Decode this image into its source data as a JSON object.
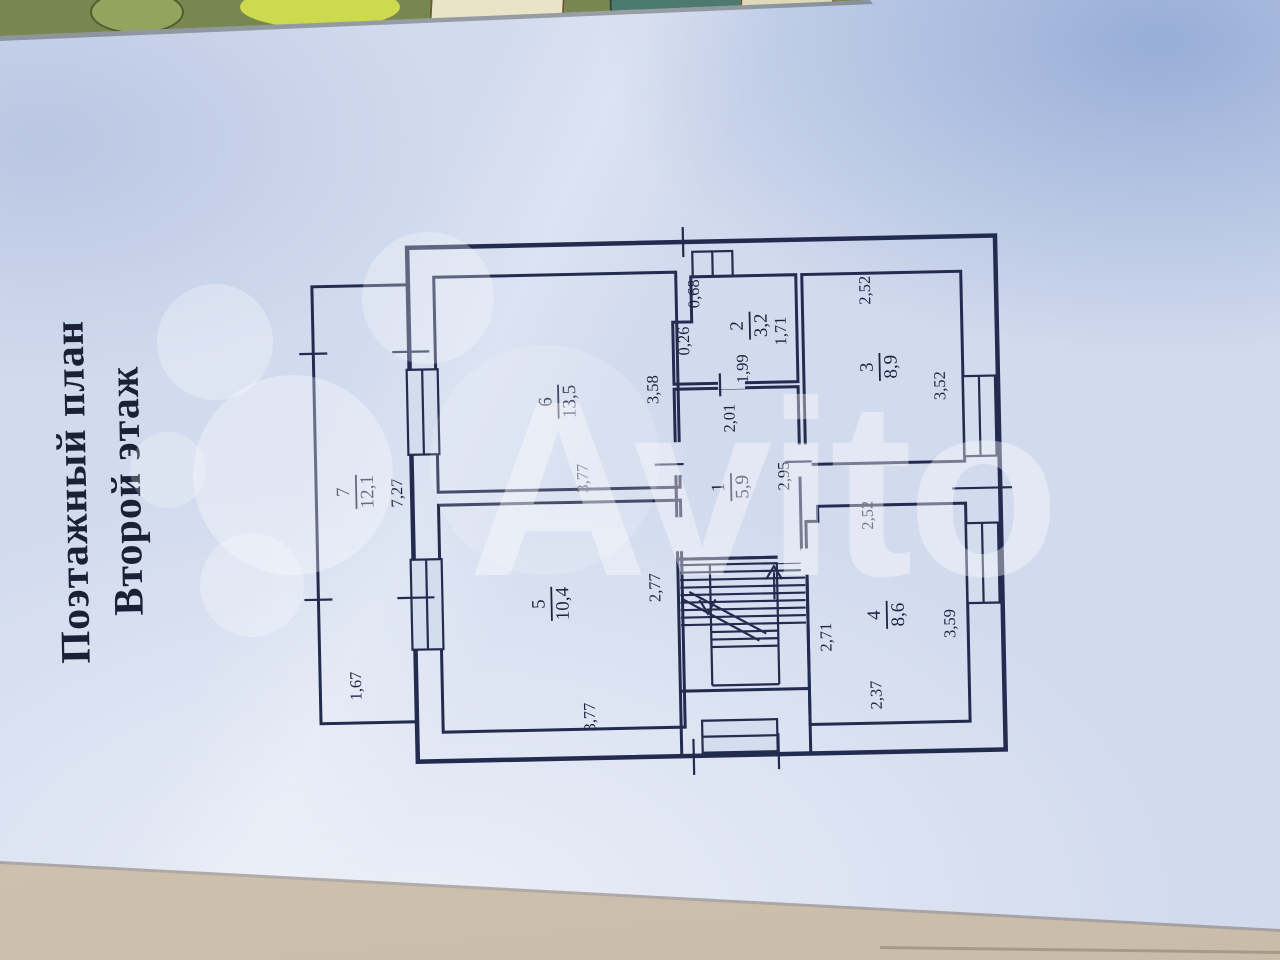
{
  "title": {
    "line1": "Поэтажный план",
    "line2": "Второй этаж"
  },
  "watermark": {
    "text": "Avito",
    "color": "#ffffff"
  },
  "rooms": {
    "r1": {
      "num": "1",
      "area": "5,9"
    },
    "r2": {
      "num": "2",
      "area": "3,2"
    },
    "r3": {
      "num": "3",
      "area": "8,9"
    },
    "r4": {
      "num": "4",
      "area": "8,6"
    },
    "r5": {
      "num": "5",
      "area": "10,4"
    },
    "r6": {
      "num": "6",
      "area": "13,5"
    },
    "r7": {
      "num": "7",
      "area": "12,1"
    }
  },
  "dims": {
    "r1_top": "2,01",
    "r1_right": "2,95",
    "r2_notch_v": "0,68",
    "r2_notch_h": "0,26",
    "r2_right": "1,71",
    "r2_bottom": "1,99",
    "r3_top": "2,52",
    "r3_right": "3,52",
    "r4_top": "2,52",
    "r4_left": "2,71",
    "r4_right": "3,59",
    "r4_bottom": "2,37",
    "r5_right": "2,77",
    "r5_bottom": "3,77",
    "r6_right": "3,58",
    "r6_bottom": "3,77",
    "r7_side": "7,27",
    "r7_end": "1,67"
  },
  "colors": {
    "ink": "#232b4f",
    "paper": "#d2dbee"
  }
}
